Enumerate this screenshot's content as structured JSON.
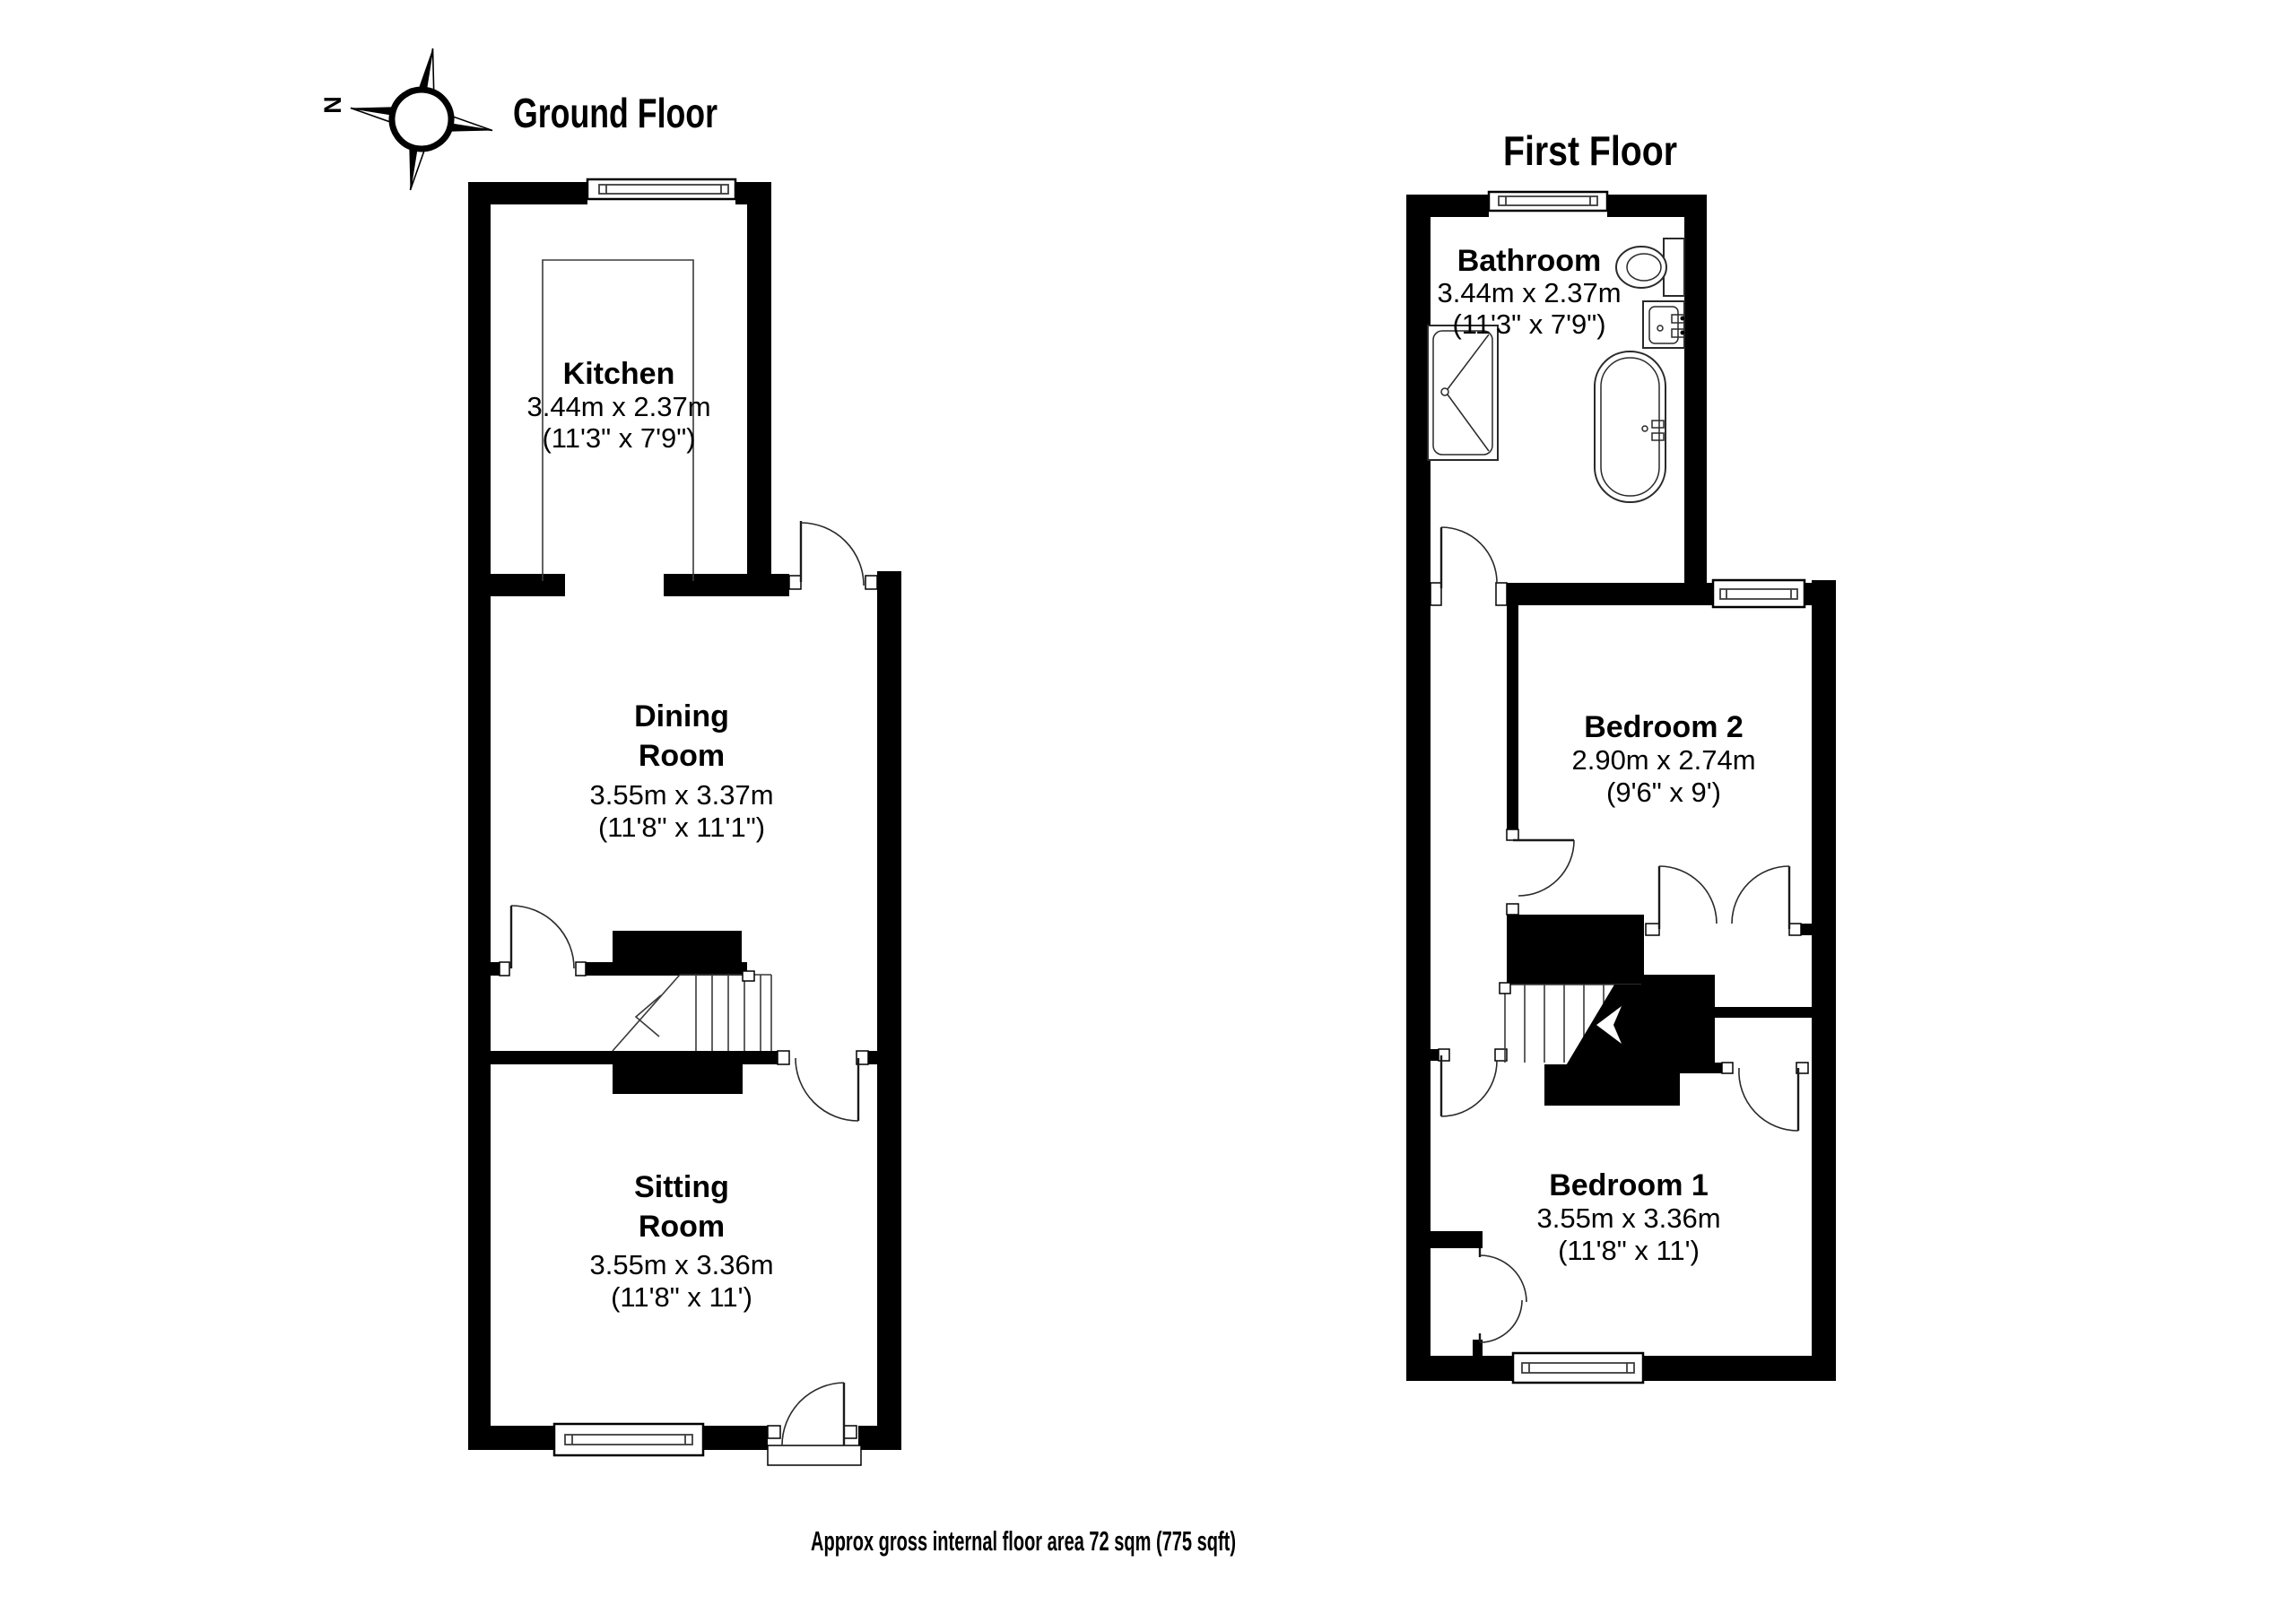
{
  "page": {
    "background": "#ffffff",
    "footer": "Approx gross internal floor area 72 sqm (775 sqft)"
  },
  "colors": {
    "wall": "#000000",
    "line": "#2a2a2a"
  },
  "compass": {
    "north_label": "N"
  },
  "floors": {
    "ground": {
      "title": "Ground Floor",
      "rooms": {
        "kitchen": {
          "name": "Kitchen",
          "metric": "3.44m x 2.37m",
          "imperial": "(11'3\" x 7'9\")"
        },
        "dining": {
          "name_line1": "Dining",
          "name_line2": "Room",
          "metric": "3.55m x 3.37m",
          "imperial": "(11'8\" x 11'1\")"
        },
        "sitting": {
          "name_line1": "Sitting",
          "name_line2": "Room",
          "metric": "3.55m x 3.36m",
          "imperial": "(11'8\" x 11')"
        }
      }
    },
    "first": {
      "title": "First Floor",
      "rooms": {
        "bathroom": {
          "name": "Bathroom",
          "metric": "3.44m x 2.37m",
          "imperial": "(11'3\" x 7'9\")"
        },
        "bedroom2": {
          "name": "Bedroom 2",
          "metric": "2.90m x 2.74m",
          "imperial": "(9'6\" x 9')"
        },
        "bedroom1": {
          "name": "Bedroom 1",
          "metric": "3.55m x 3.36m",
          "imperial": "(11'8\" x 11')"
        }
      }
    }
  }
}
